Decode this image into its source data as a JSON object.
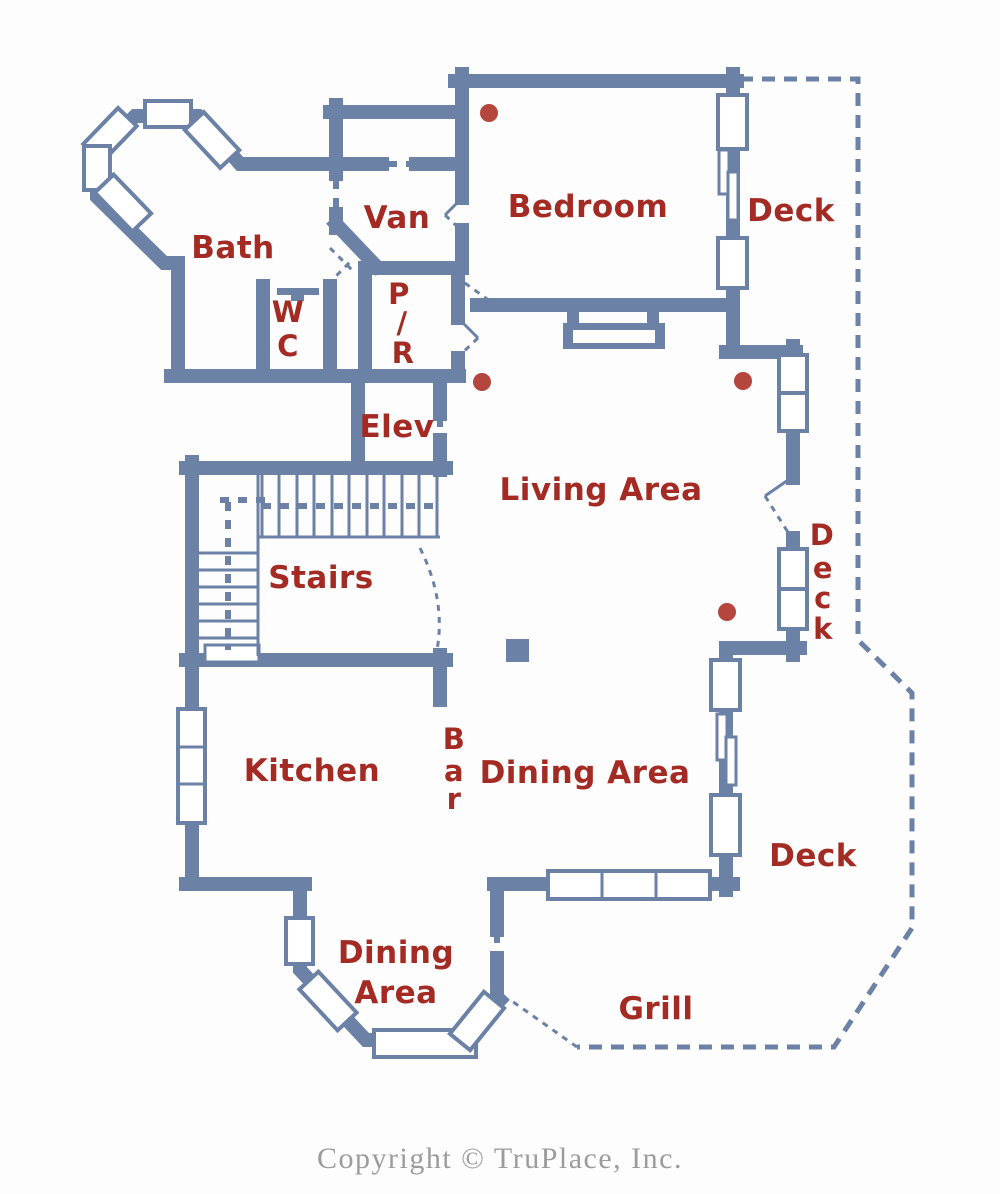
{
  "colors": {
    "wall": "#6b81a5",
    "room_label": "#a32b23",
    "ceiling_fixture_dot": "#b5463d",
    "copyright_text": "#9c9c9c",
    "background": "#fdfdfd"
  },
  "floor_plan": {
    "rooms": {
      "bath": {
        "label": "Bath"
      },
      "van": {
        "label": "Van"
      },
      "bedroom": {
        "label": "Bedroom"
      },
      "deck_top": {
        "label": "Deck"
      },
      "wc": {
        "letters": [
          "W",
          "C"
        ]
      },
      "powder_room": {
        "letters": [
          "P",
          "/",
          "R"
        ]
      },
      "elevator": {
        "label": "Elev"
      },
      "living_area": {
        "label": "Living Area"
      },
      "stairs": {
        "label": "Stairs"
      },
      "deck_right": {
        "letters": [
          "D",
          "e",
          "c",
          "k"
        ]
      },
      "kitchen": {
        "label": "Kitchen"
      },
      "bar": {
        "letters": [
          "B",
          "a",
          "r"
        ]
      },
      "dining_area": {
        "label": "Dining Area"
      },
      "dining_area_bay": {
        "lines": [
          "Dining",
          "Area"
        ]
      },
      "deck_bottom": {
        "label": "Deck"
      },
      "grill": {
        "label": "Grill"
      }
    }
  },
  "footer": {
    "copyright": "Copyright © TruPlace, Inc."
  }
}
